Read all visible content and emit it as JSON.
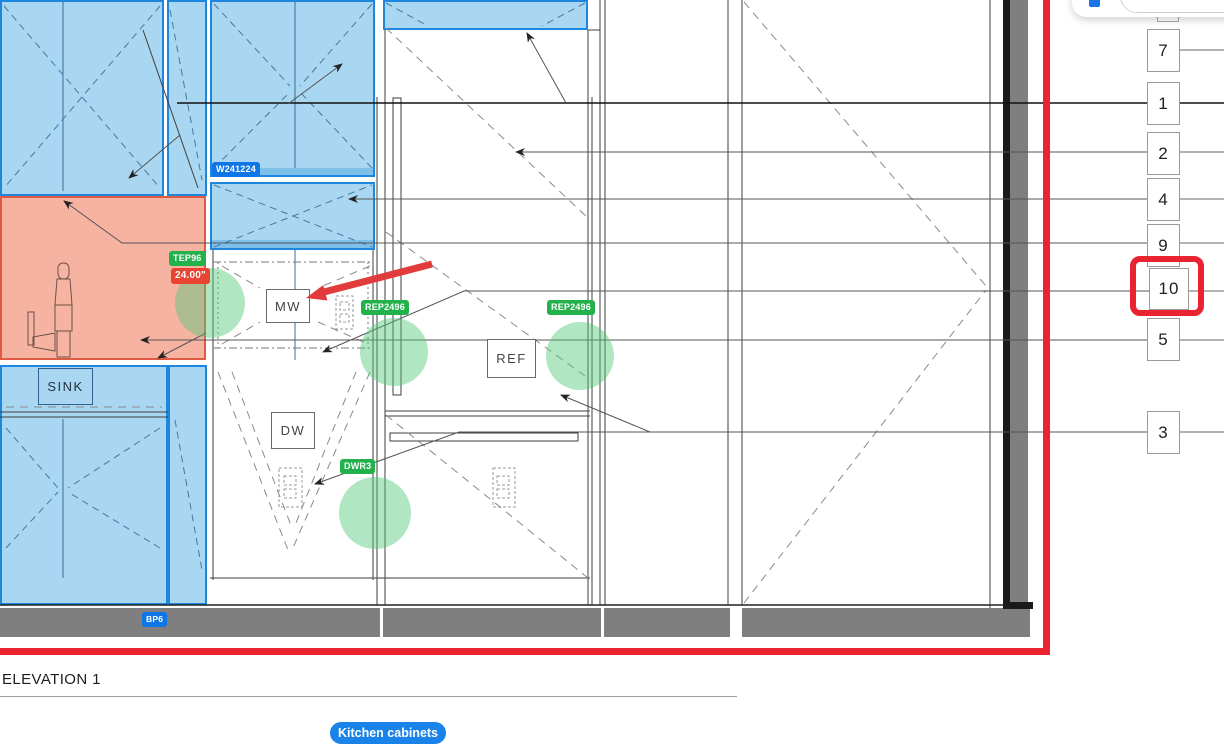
{
  "drawing": {
    "elevation_title": "ELEVATION 1",
    "category_chip_label": "Kitchen cabinets",
    "highlighted_callout": "10"
  },
  "labels": {
    "microwave": "MW",
    "dishwasher": "DW",
    "refrigerator": "REF",
    "sink": "SINK"
  },
  "tags": {
    "countertop_name": "TEP96",
    "countertop_depth": "24.00\"",
    "wall_cabinet": "W241224",
    "rep_left": "REP2496",
    "rep_right": "REP2496",
    "drawer_stack": "DWR3",
    "base_panel": "BP6"
  },
  "callouts": [
    {
      "label": "7"
    },
    {
      "label": "1"
    },
    {
      "label": "2"
    },
    {
      "label": "4"
    },
    {
      "label": "9"
    },
    {
      "label": "10"
    },
    {
      "label": "5"
    },
    {
      "label": "3"
    }
  ],
  "colors": {
    "cabinet_fill": "#a9d6f1",
    "cabinet_border": "#1e86dc",
    "counter_fill": "#f6b3a2",
    "counter_border": "#e05a41",
    "count_marker_green": "#52c87a",
    "tag_green": "#23b14c",
    "tag_blue": "#1076e8",
    "tag_red": "#e74433",
    "annotation_red": "#ea2330",
    "chip_blue": "#1a83e9",
    "toe_kick_gray": "#7f7f7f"
  }
}
